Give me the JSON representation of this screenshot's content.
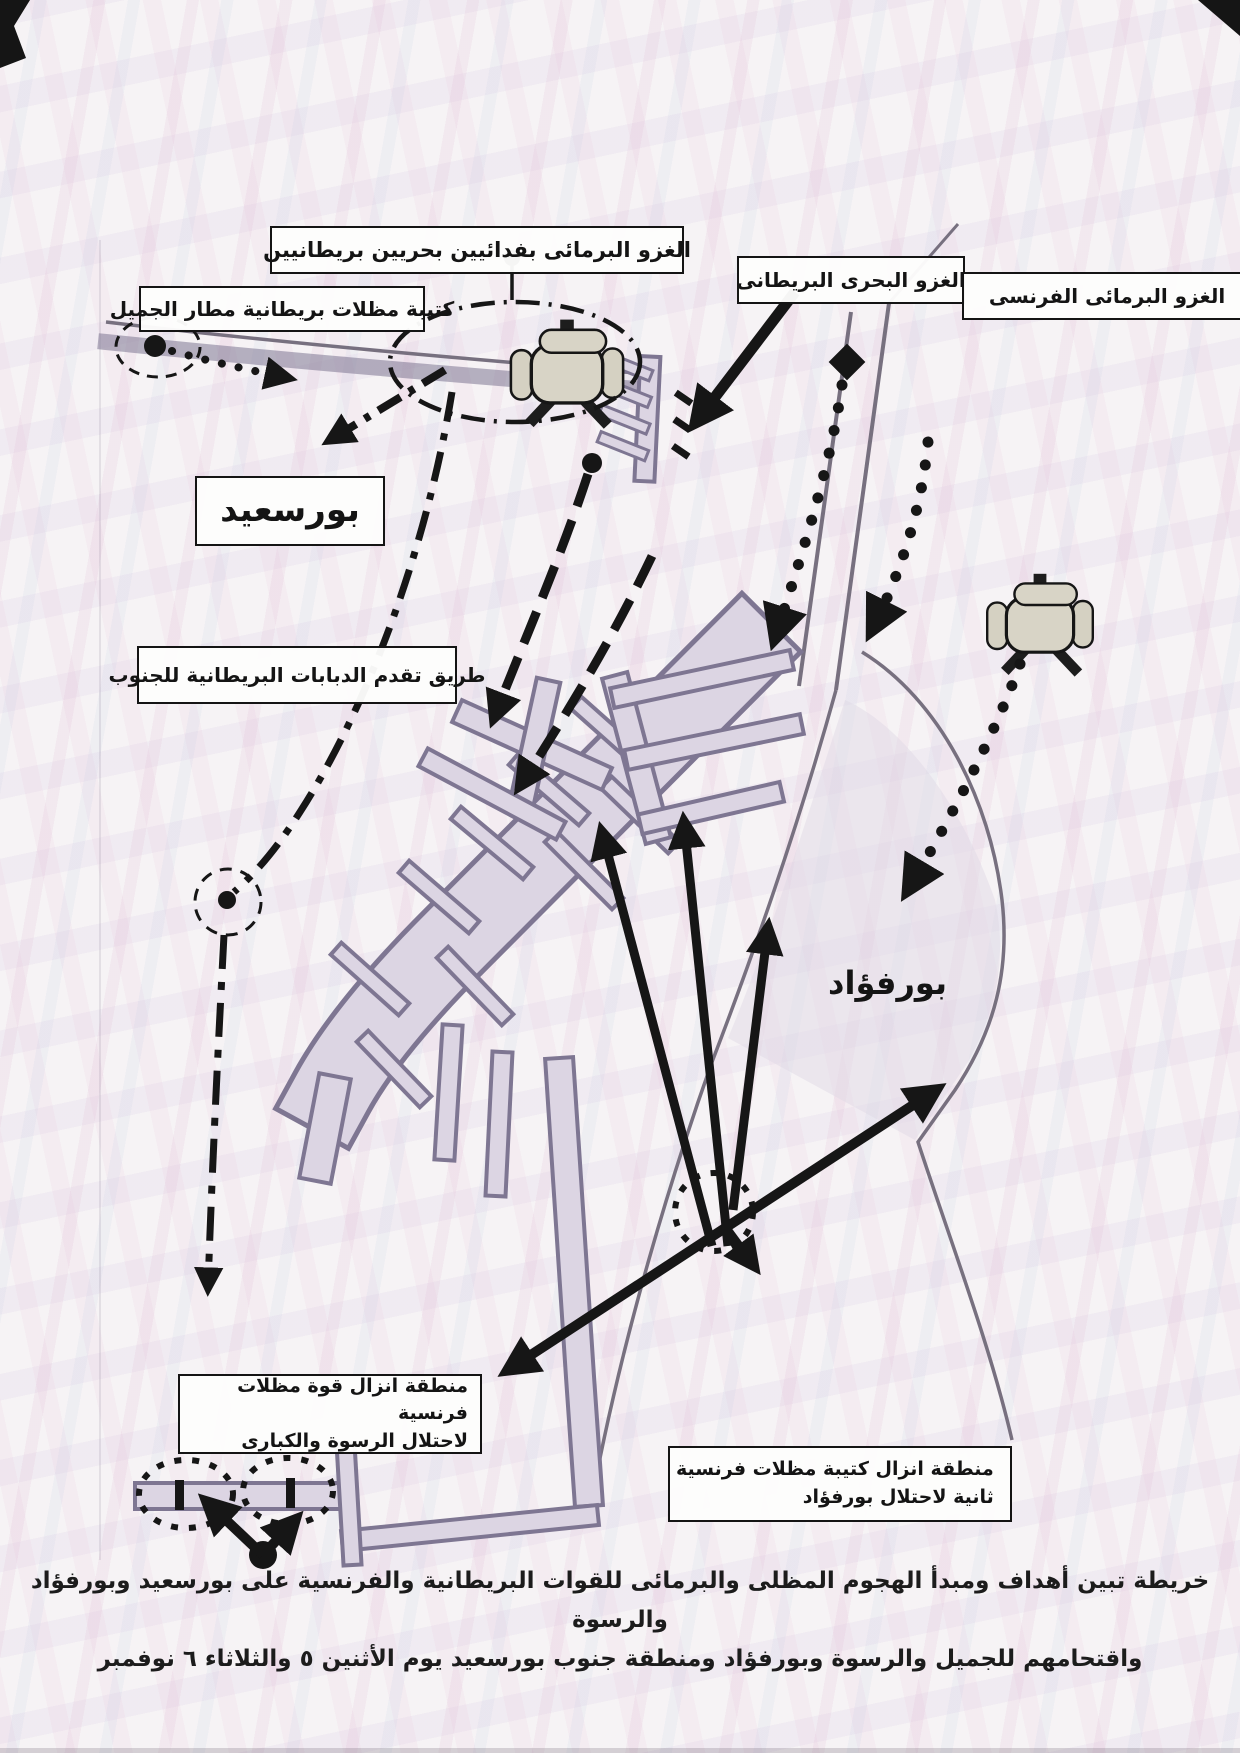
{
  "map": {
    "city_labels": {
      "port_said": "بورسعيد",
      "port_fouad": "بورفؤاد"
    },
    "callouts": {
      "amphibious_commandos": "الغزو البرمائى بفدائيين بحريين بريطانيين",
      "gamil_paratroops": "كتيبة مظلات بريطانية مطار الجميل",
      "british_naval": "الغزو البحرى البريطانى",
      "french_amphibious": "الغزو البرمائى الفرنسى",
      "tank_route": "طريق تقدم الدبابات البريطانية للجنوب",
      "raswa_drop": {
        "line1": "منطقة انزال قوة مظلات فرنسية",
        "line2": "لاحتلال الرسوة والكبارى"
      },
      "second_drop": {
        "line1": "منطقة انزال كتيبة مظلات فرنسية",
        "line2": "ثانية لاحتلال بورفؤاد"
      }
    }
  },
  "caption": {
    "line1": "خريطة تبين أهداف ومبدأ الهجوم المظلى والبرمائى للقوات البريطانية والفرنسية على بورسعيد وبورفؤاد والرسوة",
    "line2": "واقتحامهم للجميل والرسوة وبورفؤاد ومنطقة جنوب بورسعيد يوم الأثنين ٥ والثلاثاء ٦ نوفمبر"
  },
  "icons": {
    "landing_craft": "amphibious-landing-craft-icon",
    "assault_arrow": "solid-arrow",
    "airdrop_route": "dotted-arrow",
    "tank_route": "dash-dot-arrow",
    "drop_zone": "dashed-ellipse",
    "objective_marker": "dotted-circle",
    "bridge": "bridge-tick",
    "position_marker": "solid-dot",
    "diamond_marker": "solid-diamond"
  },
  "colors": {
    "ink": "#161616",
    "land_fill": "#dcd5e3",
    "land_outline": "#7e7692",
    "paper": "#f6f3f5",
    "moire_pink": "#e8d3e2",
    "moire_blue": "#dbe3ee",
    "craft_fill": "#d8d4c6",
    "label_background": "#fdfdfc"
  }
}
